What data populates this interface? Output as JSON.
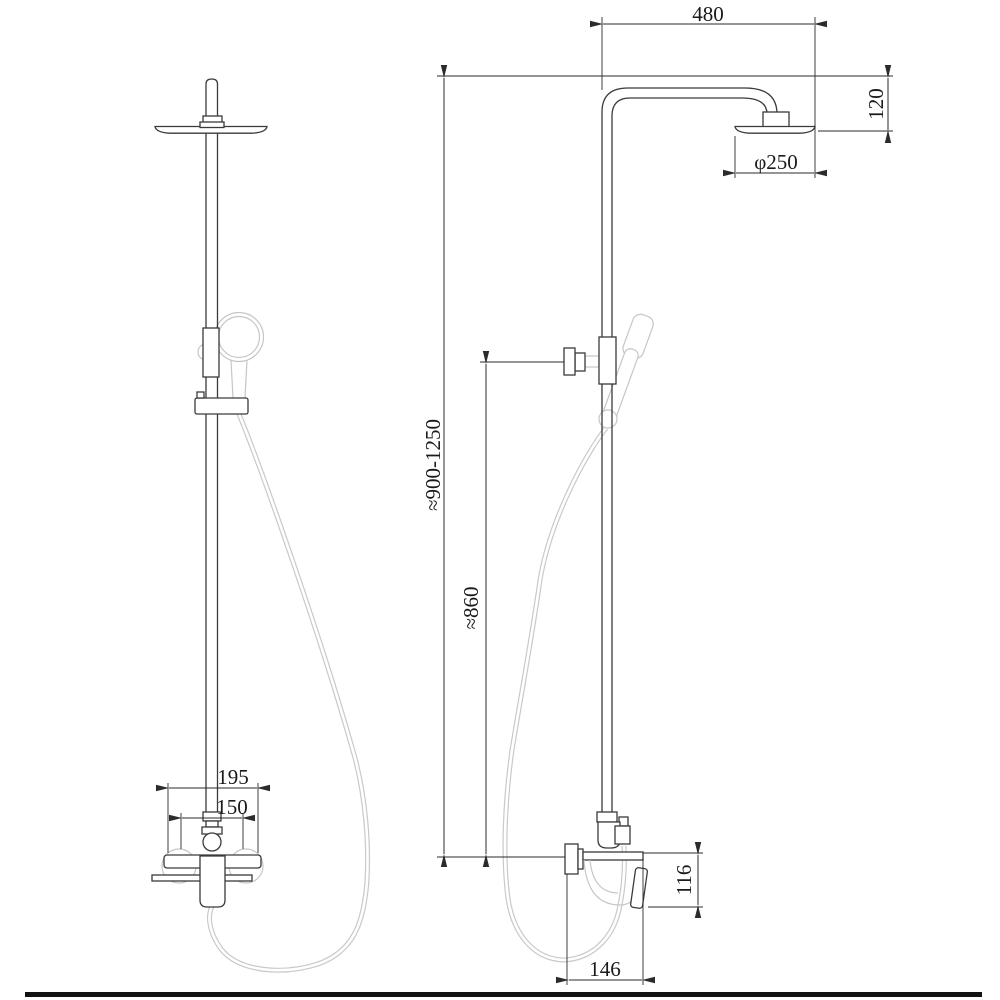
{
  "drawing": {
    "type": "shower-column-technical-drawing",
    "colors": {
      "background": "#ffffff",
      "main_line": "#3a3a3a",
      "faint_line": "#c6c6c6",
      "dimension_line": "#2b2b2b",
      "text": "#1a1a1a",
      "border_bar": "#121212"
    },
    "dimensions": {
      "arm_reach": "480",
      "head_drop": "120",
      "head_diameter": "φ250",
      "overall_height": "≈900-1250",
      "riser_height": "≈860",
      "valve_overall_width": "195",
      "valve_center_distance": "150",
      "valve_height": "116",
      "valve_depth": "146"
    }
  }
}
